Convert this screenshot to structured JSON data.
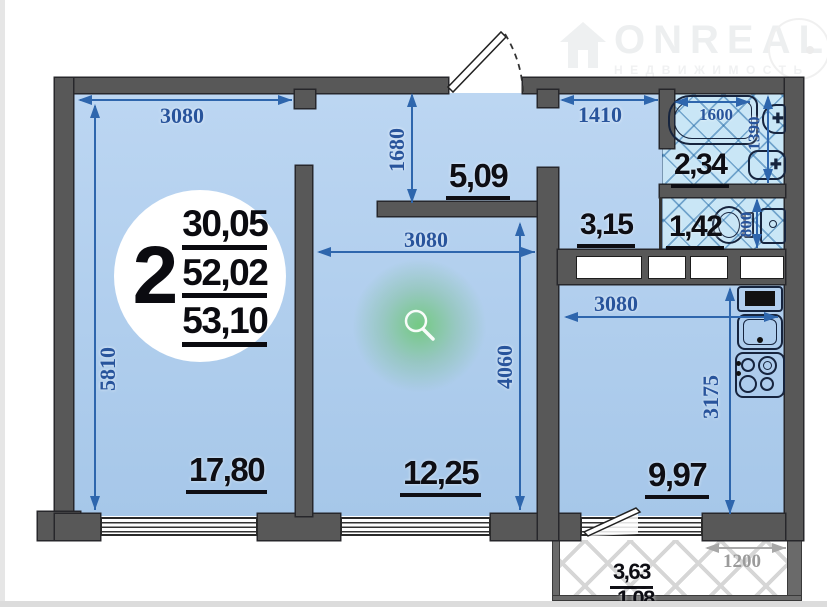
{
  "watermark": {
    "brand": "ONREAL",
    "subtitle": "НЕДВИЖИМОСТЬ"
  },
  "info_badge": {
    "rooms": "2",
    "areas": [
      "30,05",
      "52,02",
      "53,10"
    ]
  },
  "rooms": {
    "living_room": {
      "area": "17,80",
      "width_mm": "3080",
      "height_mm": "5810"
    },
    "bedroom": {
      "area": "12,25",
      "width_mm": "3080",
      "height_mm": "4060"
    },
    "kitchen": {
      "area": "9,97",
      "width_mm": "3080",
      "height_mm": "3175"
    },
    "hall": {
      "area": "5,09",
      "depth_mm": "1680"
    },
    "corridor": {
      "area": "3,15",
      "entry_width_mm": "1410"
    },
    "bathroom": {
      "area": "2,34",
      "tub_length_mm": "1600",
      "depth_mm": "1390"
    },
    "wc": {
      "area": "1,42",
      "depth_mm": "800"
    },
    "balcony": {
      "area_full": "3,63",
      "area_reduced": "1,08",
      "width_mm": "1200"
    }
  },
  "icons": {
    "tap": "✚"
  },
  "colors": {
    "wall": "#585858",
    "room_fill": "#b2cfee",
    "tile_fill": "#c9e6f6",
    "dim_blue": "#2e66ad",
    "dim_gray": "#9b9b9b",
    "label_black": "#0e0e14",
    "accent_green": "#5fc468"
  }
}
